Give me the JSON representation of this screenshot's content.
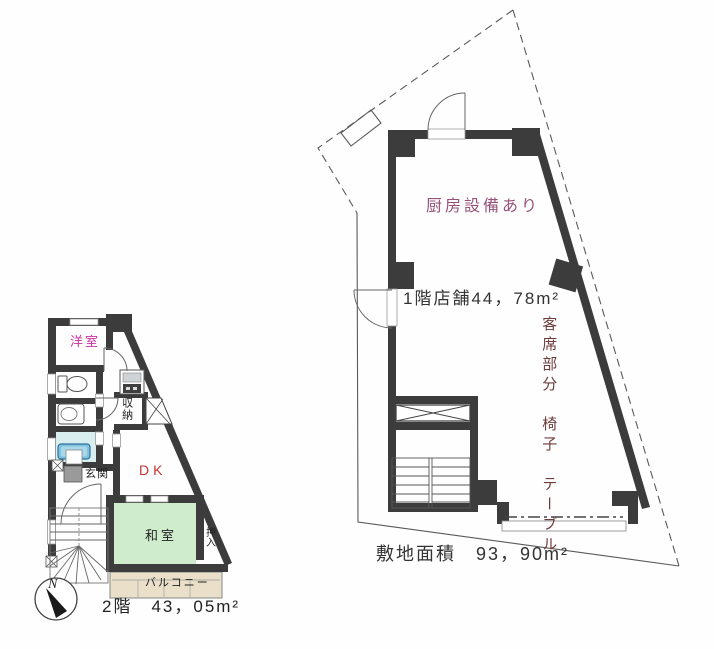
{
  "first_floor_plan": {
    "kitchen_note": "厨房設備あり",
    "area_label": "1階店舗44，78m²",
    "seating_label": "客席部分　椅子　テーブル",
    "site_area_label": "敷地面積　93，90m²"
  },
  "second_floor_plan": {
    "western_room": "洋室",
    "storage": "収納",
    "entrance": "玄関",
    "dining_kitchen": "DK",
    "japanese_room": "和室",
    "closet": "押入",
    "balcony": "バルコニー",
    "area_label": "2階　43，05m²",
    "compass_north": "N"
  },
  "colors": {
    "wall": "#3c3c3c",
    "thin_line": "#5a5a5a",
    "room_label_magenta": "#cc2f9e",
    "dk_label_red": "#c63434",
    "kitchen_note_purple": "#96527b",
    "seating_label_maroon": "#6e3c3c",
    "tatami_green": "#cfeccc",
    "bath_cyan": "#d9efef",
    "bathtub_blue": "#7fc3dd",
    "balcony_tan": "#eadfc8"
  },
  "icons": {
    "compass": "north-arrow",
    "stair_symbols": "tread-lines-and-winder-fan",
    "shaft_symbol": "box-with-x"
  }
}
